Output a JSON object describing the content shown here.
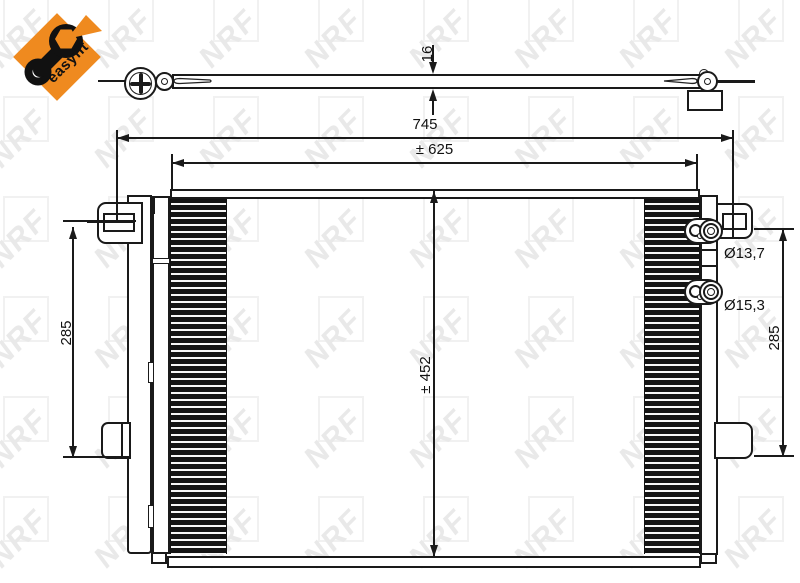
{
  "brand": {
    "easyfit_label": "easyfit",
    "watermark_text": "NRF",
    "accent_orange": "#ef8a1f",
    "line_color": "#1a1a1a",
    "watermark_color": "#e9e9e9"
  },
  "drawing": {
    "type": "condenser technical drawing, front view and top profile view",
    "labels": {
      "dim_thickness": "16",
      "dim_overall_width": "745",
      "dim_core_width": "± 625",
      "dim_core_height": "± 452",
      "dim_left_height": "285",
      "dim_right_height": "285",
      "dim_port_top": "Ø13,7",
      "dim_port_bottom": "Ø15,3"
    }
  }
}
